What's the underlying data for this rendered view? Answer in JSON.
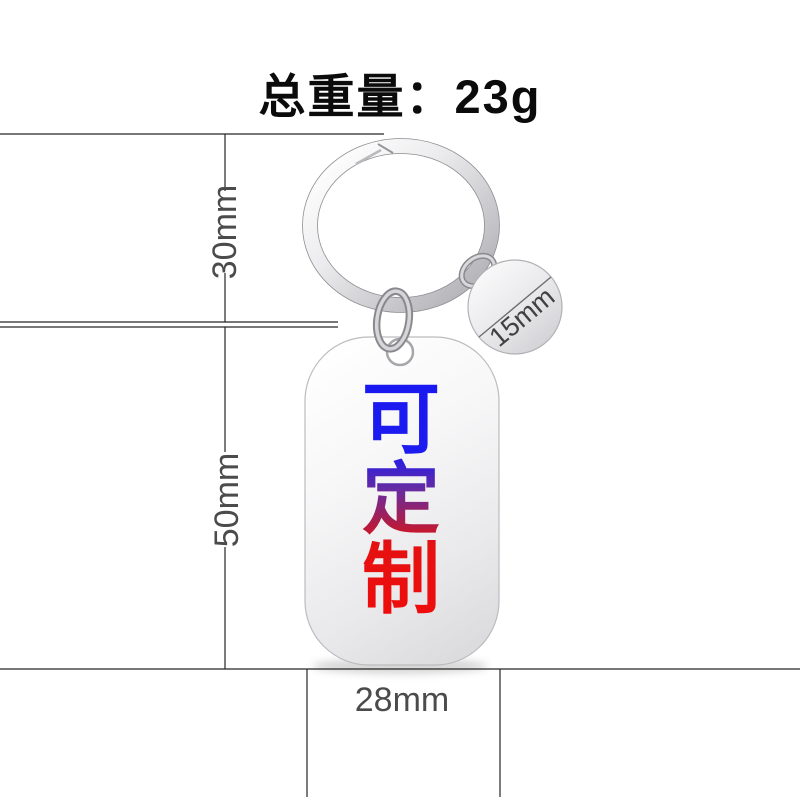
{
  "title": "总重量：23g",
  "tag": {
    "custom_text": "可定制",
    "custom_chars": [
      "可",
      "定",
      "制"
    ]
  },
  "dimensions": {
    "ring_height": "30mm",
    "tag_height": "50mm",
    "tag_width": "28mm",
    "disc_diameter": "15mm"
  },
  "colors": {
    "accent_blue": "#1c1cf0",
    "accent_red": "#ee0c0c",
    "label_gray": "#4b4b4b",
    "line_dark": "#262626",
    "metal_light": "#f5f5f7",
    "metal_dark": "#aaaaaf"
  }
}
